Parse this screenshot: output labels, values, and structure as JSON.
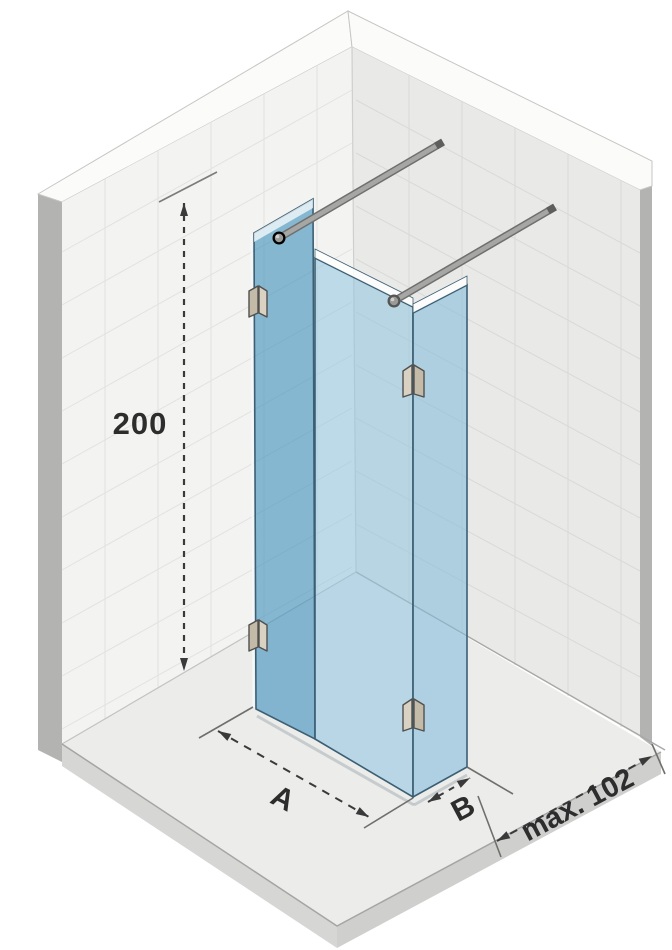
{
  "diagram": {
    "labels": {
      "height": "200",
      "width": "A",
      "depth": "B",
      "clearance": "max. 102"
    },
    "colors": {
      "glass_tall_panel": "#8fbcd5",
      "glass_front_panel": "#bbd9e8",
      "glass_side_panel": "#b2d2e4",
      "glass_edge": "#3c5f74",
      "wall_left": "#f3f3f1",
      "wall_right": "#e9e9e7",
      "floor": "#ececea",
      "floor_edge_band": "#d4d4d2",
      "support_bar": "#a6a6a4",
      "clamp_face": "#d9d1c1",
      "dimension_ink": "#3a3a3a"
    }
  }
}
